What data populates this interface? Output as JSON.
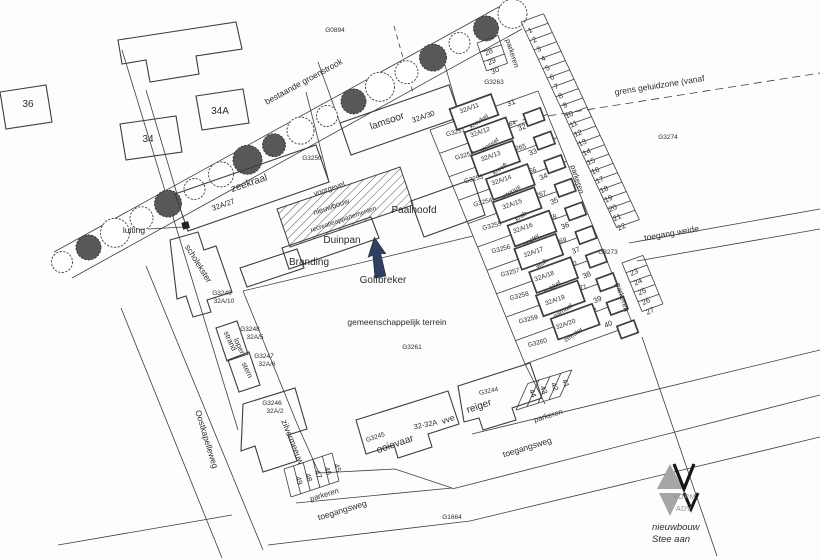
{
  "colors": {
    "line": "#3d3d3d",
    "text": "#2c2c2c",
    "arrow": "#31405f",
    "logo_gray": "#a6a6a6",
    "logo_dark": "#161616"
  },
  "parcels": {
    "g0894": "G0894",
    "g3250": "G3250",
    "g3261": "G3261",
    "g3263": "G3263",
    "g3273": "G3273",
    "g3274": "G3274",
    "g1664": "G1664"
  },
  "zones": {
    "groenstrook": "bestaande groenstrook",
    "geluidzone": "grens geluidzone (vanaf",
    "terrein": "gemeenschappelijk terrein"
  },
  "roads": {
    "oostkapelleweg": "Oostkapelleweg",
    "toegangsweg": "toegangsweg",
    "toegang_weide": "toegang weide"
  },
  "existing_houses": {
    "left": "36",
    "middle": "34",
    "right": "34A"
  },
  "buildings": {
    "zeekraal": {
      "name": "zeekraal",
      "number": "32A/27"
    },
    "lamsoor": {
      "name": "lamsoor",
      "number": "32A/30"
    },
    "scholekster": {
      "name": "scholekster",
      "plot": "G3249",
      "number": "32A/10"
    },
    "strandloper": {
      "name_line1": "strand",
      "name_line2": "loper",
      "plot": "G3248",
      "number": "32A/5"
    },
    "stern": {
      "name": "stern",
      "plot": "G3247",
      "number": "32A/6"
    },
    "zilvermeeuw": {
      "name": "zilvermeeuw",
      "plot": "G3246",
      "number": "32A/2"
    },
    "ooievaar": {
      "name": "ooievaar",
      "plot": "G3245"
    },
    "reiger": {
      "name": "reiger",
      "plot": "G3244"
    },
    "vve": {
      "range": "32-32A",
      "label": "vve"
    },
    "paalhoofd": "Paalhoofd",
    "duinpan": "Duinpan",
    "branding": "Branding",
    "golfbreker": "Golfbreker"
  },
  "new_building": {
    "facade": "voorgevel",
    "line1": "nieuwbouw",
    "line2": "recreatieappartementen"
  },
  "annotations": {
    "luiting": "luiting"
  },
  "row_houses": [
    {
      "plot": "G3251",
      "number": "32A/11",
      "name": "kreukel",
      "garden": "G3264",
      "stall": "31"
    },
    {
      "plot": "G3252",
      "number": "32A/12",
      "name": "mossel",
      "garden": "G3265",
      "stall": "32"
    },
    {
      "plot": "G3253",
      "number": "32A/13",
      "name": "kreeft",
      "garden": "G3266",
      "stall": "33"
    },
    {
      "plot": "G3254",
      "number": "32A/14",
      "name": "octopus",
      "garden": "G3267",
      "stall": "34"
    },
    {
      "plot": "G3255",
      "number": "32A/15",
      "name": "krab",
      "garden": "G3268",
      "stall": "35"
    },
    {
      "plot": "G3256",
      "number": "32A/16",
      "name": "oester",
      "garden": "G3269",
      "stall": "36"
    },
    {
      "plot": "G3257",
      "number": "32A/17",
      "name": "wulk",
      "garden": "G3270",
      "stall": "37"
    },
    {
      "plot": "G3258",
      "number": "32A/18",
      "name": "kokkel",
      "garden": "G3271",
      "stall": "38"
    },
    {
      "plot": "G3259",
      "number": "32A/19",
      "name": "garnaal",
      "garden": "G3272",
      "stall": "39"
    },
    {
      "plot": "G3260",
      "number": "32A/20",
      "name": "zeester",
      "garden": "",
      "stall": "40"
    }
  ],
  "parking": {
    "label": "parkeren",
    "stalls_main": [
      "1",
      "2",
      "3",
      "4",
      "5",
      "6",
      "7",
      "8",
      "9",
      "10",
      "11",
      "12",
      "13",
      "14",
      "15",
      "16",
      "17",
      "18",
      "19",
      "20",
      "21",
      "22"
    ],
    "stalls_nw": [
      "28",
      "29",
      "30"
    ],
    "stalls_se": [
      "23",
      "24",
      "25",
      "26",
      "27"
    ],
    "stalls_south": [
      "44",
      "43",
      "42",
      "41"
    ],
    "stalls_west": [
      "49",
      "48",
      "47",
      "46",
      "45"
    ]
  },
  "logo": {
    "brand_line1": "VORM",
    "brand_line2": "ADV",
    "caption_line1": "nieuwbouw",
    "caption_line2": "Stee aan"
  }
}
